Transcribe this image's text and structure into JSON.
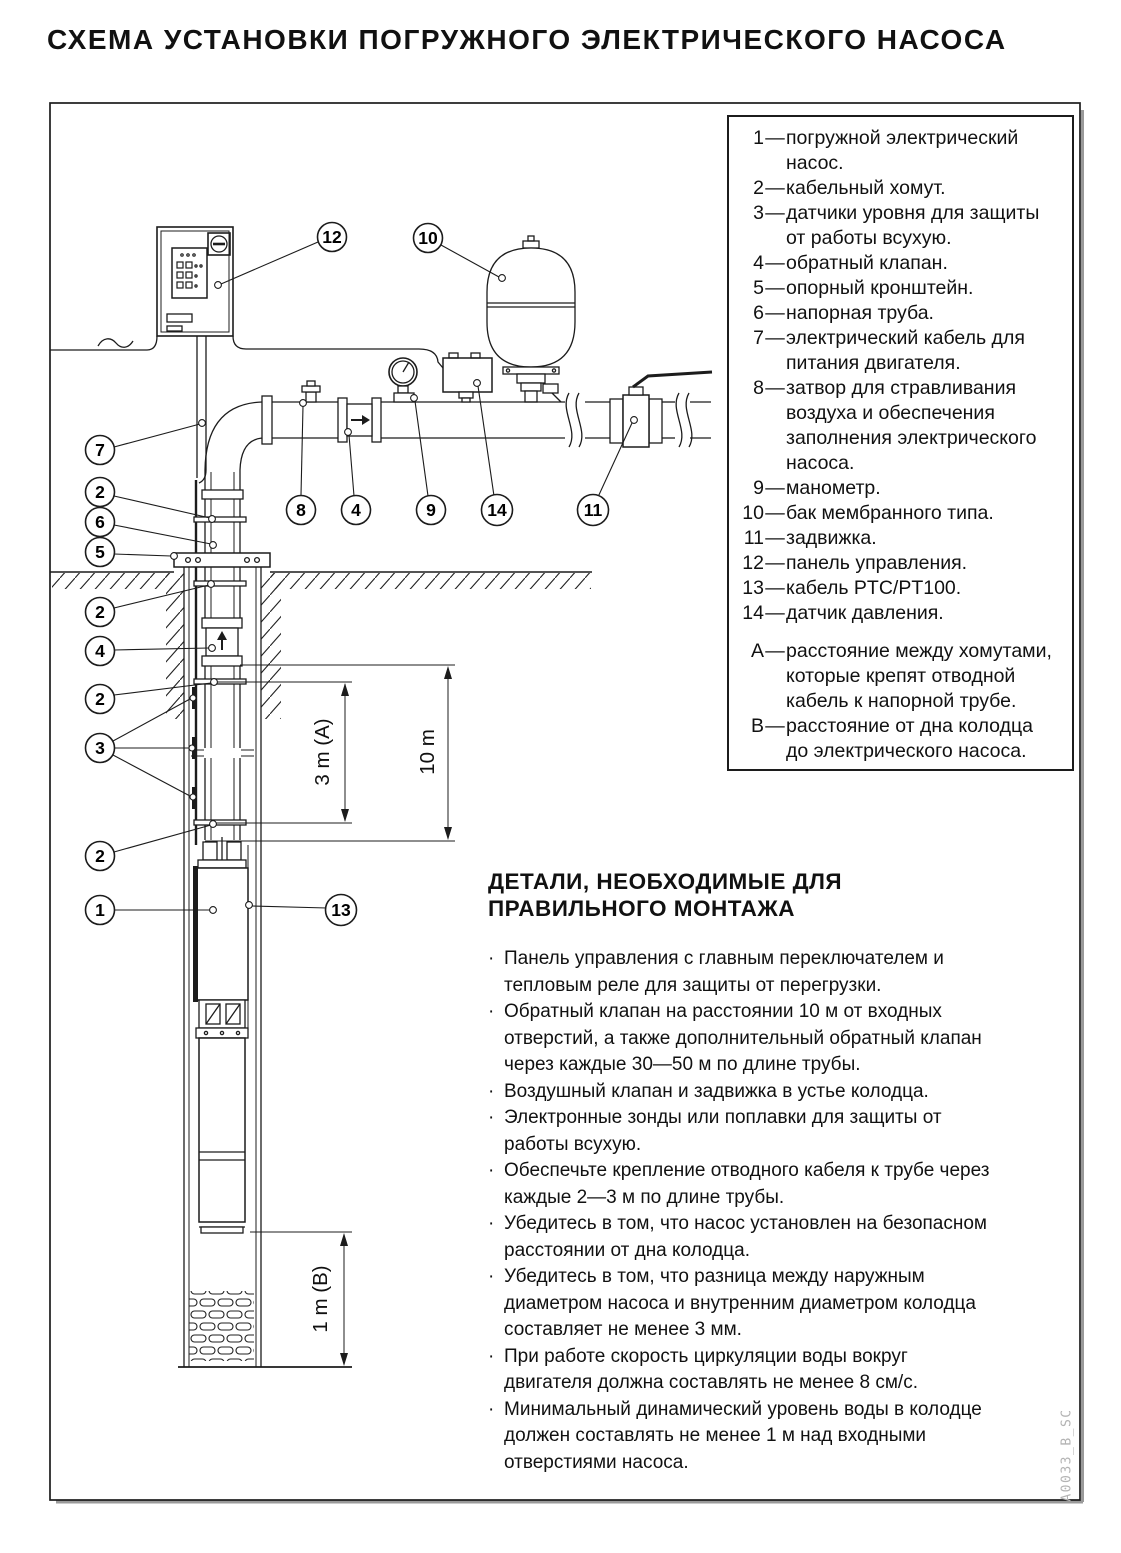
{
  "title": "СХЕМА УСТАНОВКИ ПОГРУЖНОГО ЭЛЕКТРИЧЕСКОГО НАСОСА",
  "legend": {
    "items": [
      {
        "num": "1",
        "text": "погружной электрический\nнасос."
      },
      {
        "num": "2",
        "text": "кабельный хомут."
      },
      {
        "num": "3",
        "text": "датчики уровня для защиты\nот работы всухую."
      },
      {
        "num": "4",
        "text": "обратный клапан."
      },
      {
        "num": "5",
        "text": "опорный кронштейн."
      },
      {
        "num": "6",
        "text": "напорная труба."
      },
      {
        "num": "7",
        "text": "электрический кабель для\nпитания двигателя."
      },
      {
        "num": "8",
        "text": "затвор для стравливания\nвоздуха и обеспечения\nзаполнения электрического\nнасоса."
      },
      {
        "num": "9",
        "text": "манометр."
      },
      {
        "num": "10",
        "text": "бак мембранного типа."
      },
      {
        "num": "11",
        "text": "задвижка."
      },
      {
        "num": "12",
        "text": "панель управления."
      },
      {
        "num": "13",
        "text": "кабель PTC/PT100."
      },
      {
        "num": "14",
        "text": "датчик давления."
      }
    ],
    "notes": [
      {
        "num": "A",
        "text": "расстояние между хомутами,\nкоторые крепят отводной\nкабель к напорной трубе."
      },
      {
        "num": "B",
        "text": "расстояние от дна колодца\nдо электрического насоса."
      }
    ],
    "dash": "—"
  },
  "details": {
    "heading": "ДЕТАЛИ, НЕОБХОДИМЫЕ ДЛЯ\nПРАВИЛЬНОГО МОНТАЖА",
    "bullet_mark": "·",
    "bullets": [
      {
        "text": "Панель управления с главным переключателем и\nтепловым реле для защиты от перегрузки."
      },
      {
        "text": "Обратный клапан на расстоянии 10 м от входных\nотверстий, а также дополнительный обратный клапан\nчерез каждые 30—50 м по длине трубы."
      },
      {
        "text": "Воздушный клапан и задвижка в устье колодца."
      },
      {
        "text": "Электронные зонды или поплавки для защиты от\nработы всухую."
      },
      {
        "text": "Обеспечьте крепление отводного кабеля к трубе через\nкаждые 2—3 м по длине трубы."
      },
      {
        "text": "Убедитесь в том, что насос установлен на безопасном\nрасстоянии от дна колодца."
      },
      {
        "text": "Убедитесь в том, что разница между наружным\nдиаметром насоса и внутренним диаметром колодца\nсоставляет не менее 3 мм."
      },
      {
        "text": "При работе скорость циркуляции воды вокруг\nдвигателя должна составлять не менее 8 см/с."
      },
      {
        "text": "Минимальный динамический уровень воды в колодце\nдолжен составлять не менее 1 м над входными\nотверстиями насоса."
      }
    ]
  },
  "diagram": {
    "dimensions": {
      "a": "3 m (A)",
      "ten": "10 m",
      "b": "1 m (B)"
    },
    "callouts": [
      {
        "label": "12"
      },
      {
        "label": "10"
      },
      {
        "label": "7"
      },
      {
        "label": "2"
      },
      {
        "label": "6"
      },
      {
        "label": "5"
      },
      {
        "label": "8"
      },
      {
        "label": "4"
      },
      {
        "label": "9"
      },
      {
        "label": "14"
      },
      {
        "label": "11"
      },
      {
        "label": "2"
      },
      {
        "label": "4"
      },
      {
        "label": "2"
      },
      {
        "label": "3"
      },
      {
        "label": "2"
      },
      {
        "label": "1"
      },
      {
        "label": "13"
      }
    ]
  },
  "watermark": "A0033_B_SC"
}
